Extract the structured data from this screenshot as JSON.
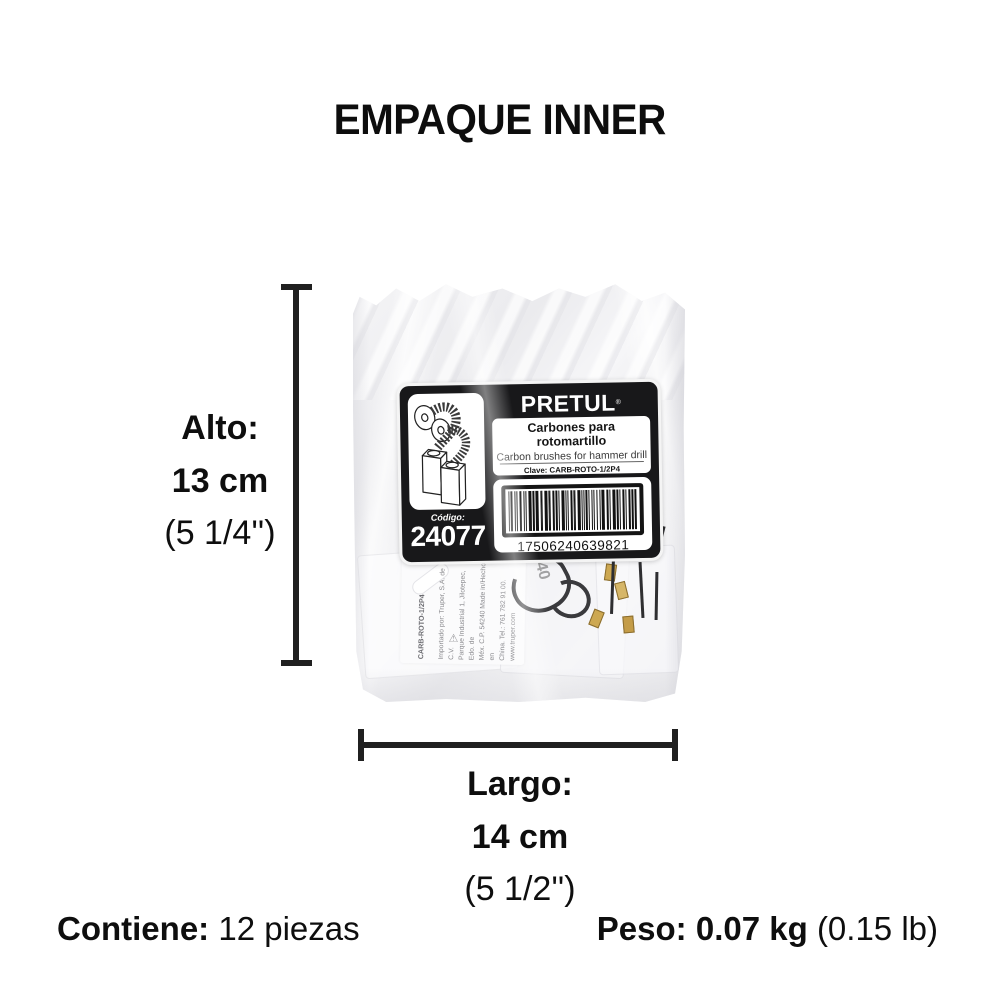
{
  "page": {
    "title": "EMPAQUE INNER"
  },
  "label": {
    "brand": "PRETUL",
    "brand_mark": "®",
    "product_name_es": "Carbones para rotomartillo",
    "product_name_en": "Carbon brushes for hammer drill",
    "clave_label": "Clave:",
    "clave_value": "CARB-ROTO-1/2P4",
    "cont_label": "CONT.:",
    "cont_value": "12 JUEGOS / SETS",
    "codigo_label": "Código:",
    "codigo_value": "24077",
    "barcode_number": "17506240639821"
  },
  "dimensions": {
    "alto": {
      "label": "Alto:",
      "value": "13 cm",
      "inches": "(5 1/4'')"
    },
    "largo": {
      "label": "Largo:",
      "value": "14 cm",
      "inches": "(5 1/2'')"
    }
  },
  "footer": {
    "contiene_label": "Contiene:",
    "contiene_value": "12 piezas",
    "peso_label": "Peso:",
    "peso_value": "0.07 kg",
    "peso_alt": "(0.15 lb)"
  },
  "inner_card": {
    "sku_vertical": "CARB-ROTO-1/2P4",
    "faint_marking": "40",
    "importer_lines": [
      "Importado por: Truper, S.A. de C.V.",
      "Parque Industrial 1, Jilotepec, Edo. de",
      "Méx. C.P. 54240 Made in/Hecho en",
      "China. Tel.: 761 782 91 00.",
      "www.truper.com"
    ]
  },
  "colors": {
    "label_black": "#18181a",
    "bag_gray": "#ededef",
    "brass": "#cda852",
    "text_black": "#0e0e0e"
  }
}
